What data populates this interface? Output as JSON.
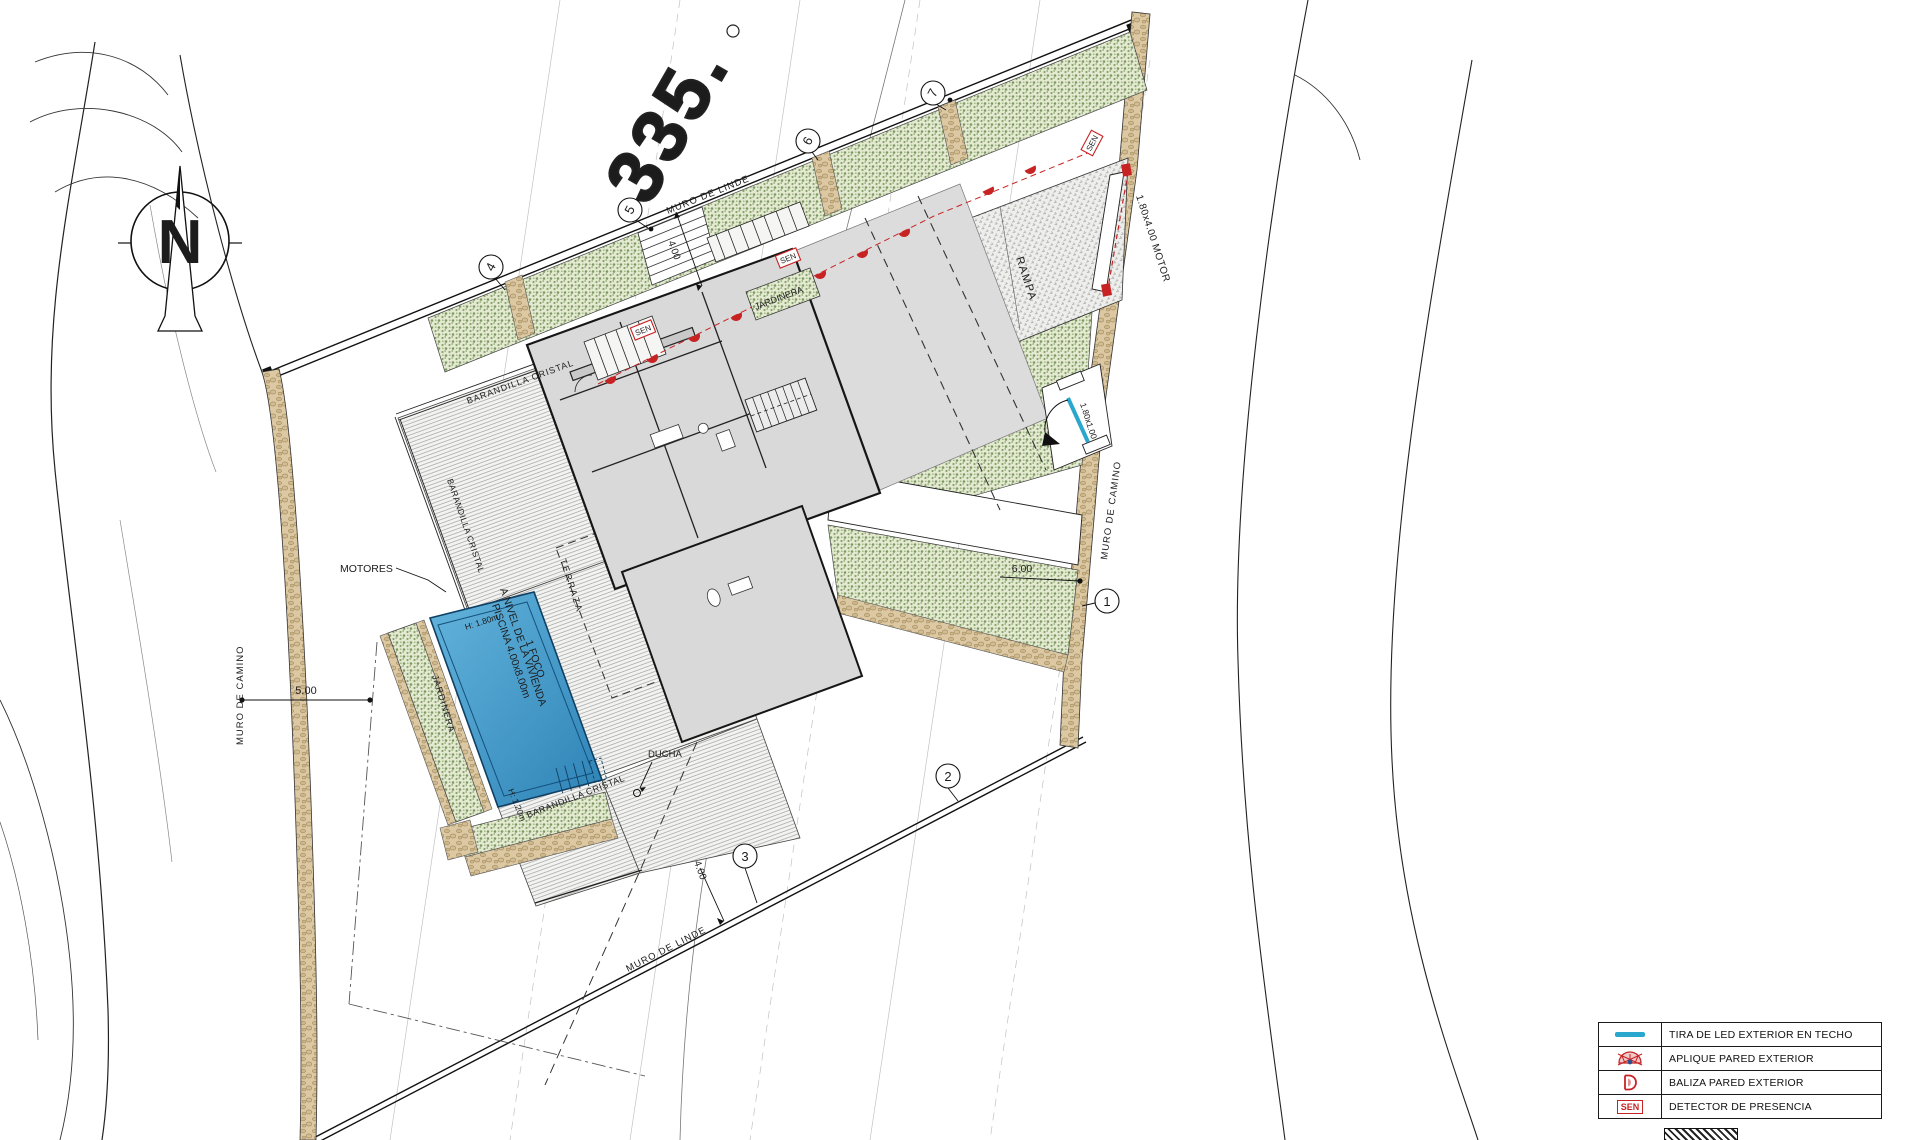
{
  "colors": {
    "accent_cyan": "#2aa7cc",
    "accent_red": "#c82323",
    "veg_green": "#8aa46c",
    "stone_tan": "#d8c59e",
    "pool_blue": "#4aa0cd"
  },
  "north_arrow": {
    "label": "N"
  },
  "contour": {
    "elevation_label": "335."
  },
  "walls": {
    "top": "MURO DE LINDE",
    "bottom": "MURO DE LINDE",
    "left": "MURO DE CAMINO",
    "right": "MURO DE CAMINO"
  },
  "dimensions": {
    "top": "4.00",
    "left": "5.00",
    "right": "6.00",
    "bottom": "4.00"
  },
  "markers": {
    "m1": "1",
    "m2": "2",
    "m3": "3",
    "m4": "4",
    "m5": "5",
    "m6": "6",
    "m7": "7"
  },
  "areas": {
    "rampa": "RAMPA",
    "terraza": "TERRAZA",
    "jardinera_top": "JARDINERA",
    "jardinera_pool": "JARDINERA"
  },
  "features": {
    "barandilla_top": "BARANDILLA CRISTAL",
    "barandilla_left": "BARANDILLA CRISTAL",
    "barandilla_bottom": "BARANDILLA CRISTAL",
    "motores": "MOTORES",
    "ducha": "DUCHA",
    "gate_motor": "1.80x4.00 MOTOR",
    "gate_ped": "1.80x1.00",
    "sen": "SEN",
    "pool_height_top": "H: 1.80m",
    "pool_height_bottom": "H: 1.20m"
  },
  "pool": {
    "line1": "PISCINA 4.00x8.00m",
    "line2": "A NIVEL DE LA VIVIENDA",
    "line3": "1 FOCO"
  },
  "legend": {
    "baliza_letter": "D",
    "rows": [
      {
        "symbol": "led-strip",
        "label": "TIRA DE LED EXTERIOR EN TECHO"
      },
      {
        "symbol": "aplique",
        "label": "APLIQUE PARED EXTERIOR"
      },
      {
        "symbol": "baliza",
        "label": "BALIZA PARED EXTERIOR"
      },
      {
        "symbol": "sen",
        "label": "DETECTOR DE PRESENCIA"
      }
    ]
  }
}
